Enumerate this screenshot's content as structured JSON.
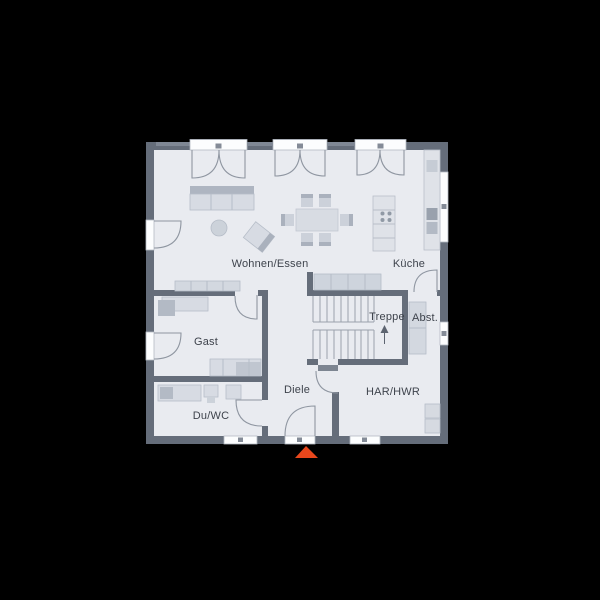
{
  "floorplan": {
    "rooms": {
      "wohnen_essen": {
        "label": "Wohnen/Essen"
      },
      "kueche": {
        "label": "Küche"
      },
      "gast": {
        "label": "Gast"
      },
      "treppe": {
        "label": "Treppe"
      },
      "abstellraum": {
        "label": "Abst."
      },
      "diele": {
        "label": "Diele"
      },
      "du_wc": {
        "label": "Du/WC"
      },
      "har_hwr": {
        "label": "HAR/HWR"
      }
    },
    "entrance": {
      "marker": "arrow-up",
      "color": "#e8471c"
    },
    "colors": {
      "background": "#000000",
      "floor": "#e9ebf0",
      "walls": "#656d7a",
      "furniture": "#d7dbe3",
      "lines": "#8f96a1"
    }
  }
}
